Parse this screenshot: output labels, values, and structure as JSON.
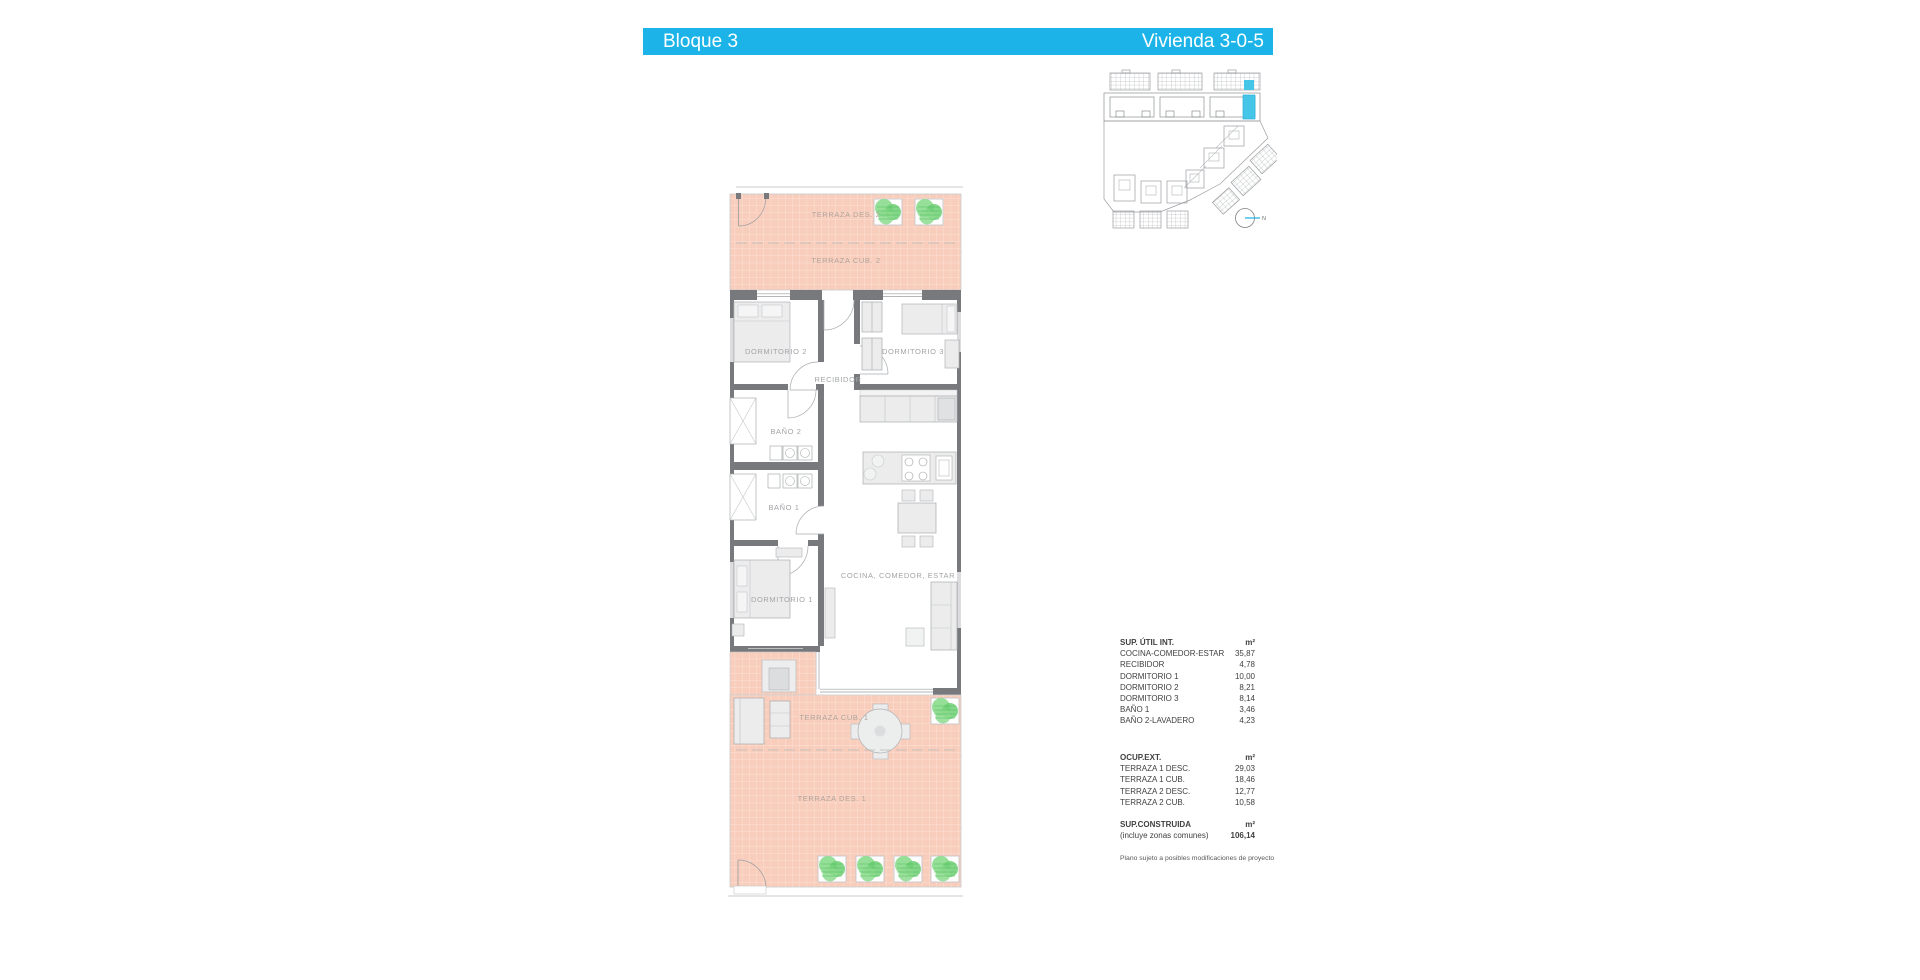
{
  "header": {
    "left_title": "Bloque 3",
    "right_title": "Vivienda 3-0-5"
  },
  "site_plan": {
    "north_label": "N"
  },
  "floor_plan": {
    "labels": {
      "terraza_des_2": "TERRAZA DES. 2",
      "terraza_cub_2": "TERRAZA CUB. 2",
      "dormitorio_2": "DORMITORIO 2",
      "dormitorio_3": "DORMITORIO 3",
      "recibidor": "RECIBIDOR",
      "bano_2": "BAÑO 2",
      "bano_1": "BAÑO 1",
      "cocina_comedor_estar": "COCINA, COMEDOR, ESTAR",
      "dormitorio_1": "DORMITORIO 1",
      "terraza_cub_1": "TERRAZA CUB. 1",
      "terraza_des_1": "TERRAZA DES. 1"
    }
  },
  "tables": {
    "interior": {
      "title": "SUP. ÚTIL INT.",
      "unit": "m²",
      "rows": [
        {
          "label": "COCINA-COMEDOR-ESTAR",
          "value": "35,87"
        },
        {
          "label": "RECIBIDOR",
          "value": "4,78"
        },
        {
          "label": "DORMITORIO 1",
          "value": "10,00"
        },
        {
          "label": "DORMITORIO 2",
          "value": "8,21"
        },
        {
          "label": "DORMITORIO 3",
          "value": "8,14"
        },
        {
          "label": "BAÑO 1",
          "value": "3,46"
        },
        {
          "label": "BAÑO 2-LAVADERO",
          "value": "4,23"
        }
      ]
    },
    "exterior": {
      "title": "OCUP.EXT.",
      "unit": "m²",
      "rows": [
        {
          "label": "TERRAZA 1 DESC.",
          "value": "29,03"
        },
        {
          "label": "TERRAZA 1 CUB.",
          "value": "18,46"
        },
        {
          "label": "TERRAZA 2 DESC.",
          "value": "12,77"
        },
        {
          "label": "TERRAZA 2 CUB.",
          "value": "10,58"
        }
      ]
    },
    "constructed": {
      "title": "SUP.CONSTRUIDA",
      "unit": "m²",
      "note": "(incluye zonas comunes)",
      "value": "106,14"
    },
    "footnote": "Plano sujeto a posibles modificaciones de proyecto"
  },
  "colors": {
    "accent_bar": "#1cb4e8",
    "unit_highlight": "#45c6e8",
    "terrace_fill": "#f8cdbb",
    "wall": "#77797c",
    "plant_green": "#7cd47c",
    "label_gray": "#a2a4a7"
  }
}
